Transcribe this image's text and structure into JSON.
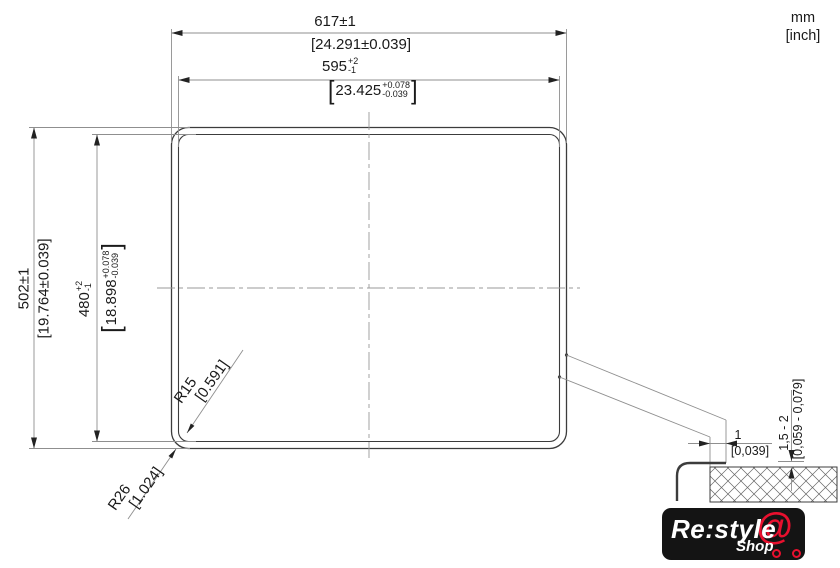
{
  "header": {
    "unit_metric": "mm",
    "unit_imperial": "[inch]"
  },
  "dimensions": {
    "outer_width_mm": "617±1",
    "outer_width_inch": "[24.291±0.039]",
    "cutout_width_mm": "595",
    "cutout_width_tol_plus": "+2",
    "cutout_width_tol_minus": "-1",
    "cutout_width_inch": "23.425",
    "cutout_width_inch_tol_plus": "+0.078",
    "cutout_width_inch_tol_minus": "-0.039",
    "outer_height_mm": "502±1",
    "outer_height_inch": "[19.764±0.039]",
    "cutout_height_mm": "480",
    "cutout_height_tol_plus": "+2",
    "cutout_height_tol_minus": "-1",
    "cutout_height_inch": "18.898",
    "cutout_height_inch_tol_plus": "+0.078",
    "cutout_height_inch_tol_minus": "-0.039",
    "inner_radius_mm": "R15",
    "inner_radius_inch": "[0.591]",
    "outer_radius_mm": "R26",
    "outer_radius_inch": "[1.024]",
    "reveal_mm": "1",
    "reveal_inch": "[0,039]",
    "rim_height_mm": "1,5 - 2",
    "rim_height_inch": "[0,059 - 0,079]"
  },
  "brackets": {
    "open": "[",
    "close": "]"
  },
  "logo": {
    "brand": "Re:style",
    "sub": "Shop",
    "cart_at": "@"
  },
  "colors": {
    "object_line": "#3c3c3c",
    "dim_line": "#8f8f8f",
    "text": "#1a1a1a",
    "logo_bg": "#141414",
    "logo_red": "#e8102e",
    "logo_text": "#ffffff"
  }
}
